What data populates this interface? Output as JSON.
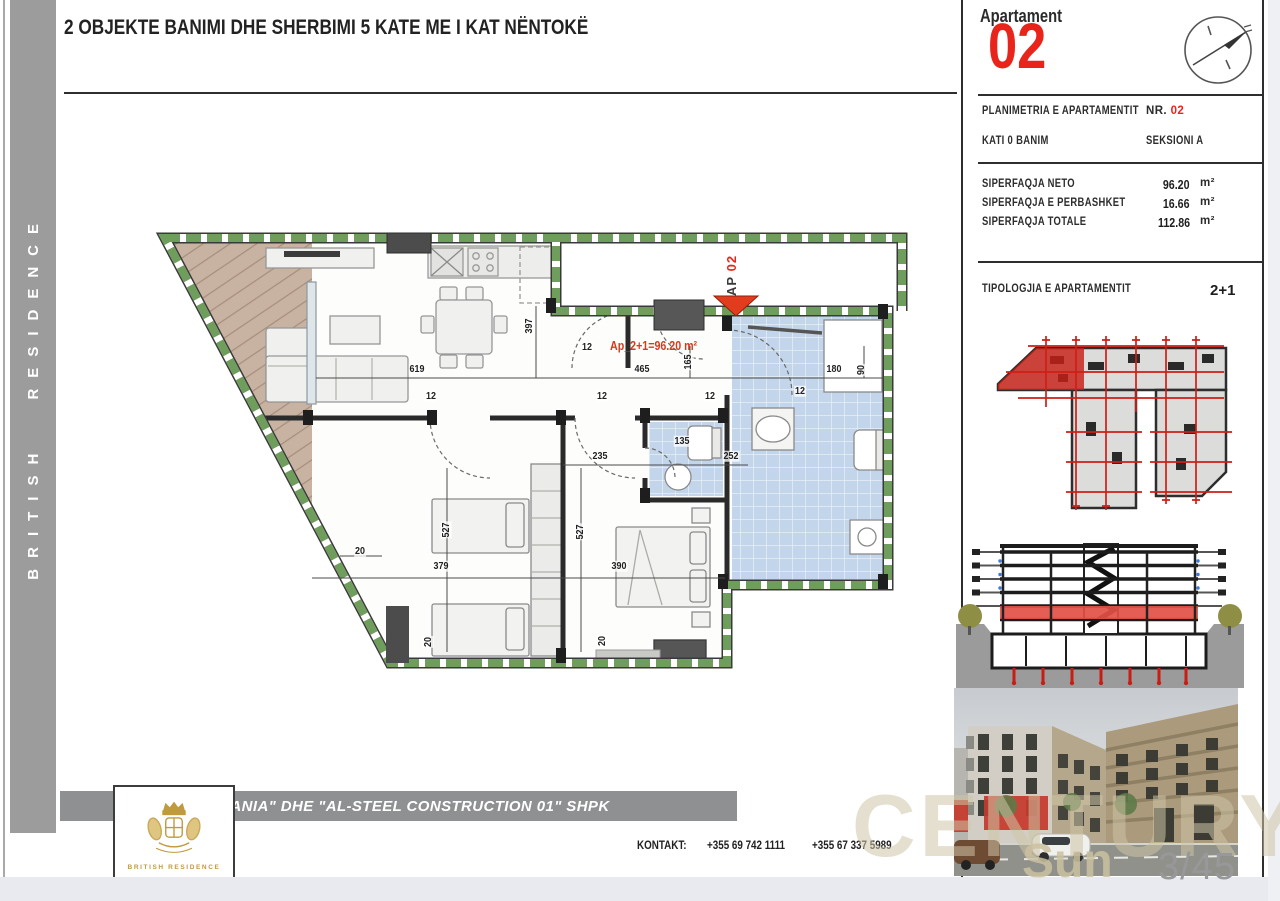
{
  "header": {
    "title": "2 OBJEKTE BANIMI DHE SHERBIMI 5 KATE ME I KAT NËNTOKË"
  },
  "sidebar": {
    "brand": "BRITISH RESIDENCE"
  },
  "logo": {
    "name": "BRITISH RESIDENCE"
  },
  "apartment_panel": {
    "label": "Apartament",
    "number": "02",
    "plan_row": {
      "label": "PLANIMETRIA E APARTAMENTIT",
      "nr_label": "NR.",
      "nr_value": "02"
    },
    "floor_row": {
      "label": "KATI 0 BANIM",
      "section": "SEKSIONI A"
    },
    "areas": [
      {
        "label": "SIPERFAQJA NETO",
        "value": "96.20",
        "unit": "m²"
      },
      {
        "label": "SIPERFAQJA E PERBASHKET",
        "value": "16.66",
        "unit": "m²"
      },
      {
        "label": "SIPERFAQJA TOTALE",
        "value": "112.86",
        "unit": "m²"
      }
    ],
    "typology": {
      "label": "TIPOLOGJIA E APARTAMENTIT",
      "value": "2+1"
    }
  },
  "floor_plan": {
    "entrance_marker_prefix": "AP",
    "entrance_marker_number": "02",
    "area_text": "Ap_2+1=96.20 m²",
    "dimensions": [
      {
        "t": "619",
        "x": 417,
        "y": 369
      },
      {
        "t": "465",
        "x": 642,
        "y": 369
      },
      {
        "t": "180",
        "x": 834,
        "y": 369
      },
      {
        "t": "397",
        "x": 529,
        "y": 326,
        "r": -90
      },
      {
        "t": "165",
        "x": 688,
        "y": 362,
        "r": -90
      },
      {
        "t": "90",
        "x": 861,
        "y": 370,
        "r": -90
      },
      {
        "t": "12",
        "x": 431,
        "y": 396
      },
      {
        "t": "12",
        "x": 602,
        "y": 396
      },
      {
        "t": "12",
        "x": 710,
        "y": 396
      },
      {
        "t": "12",
        "x": 800,
        "y": 391
      },
      {
        "t": "12",
        "x": 587,
        "y": 347
      },
      {
        "t": "135",
        "x": 682,
        "y": 441
      },
      {
        "t": "235",
        "x": 600,
        "y": 456
      },
      {
        "t": "252",
        "x": 731,
        "y": 456
      },
      {
        "t": "527",
        "x": 446,
        "y": 530,
        "r": -90
      },
      {
        "t": "527",
        "x": 580,
        "y": 532,
        "r": -90
      },
      {
        "t": "379",
        "x": 441,
        "y": 566
      },
      {
        "t": "390",
        "x": 619,
        "y": 566
      },
      {
        "t": "20",
        "x": 360,
        "y": 551
      },
      {
        "t": "20",
        "x": 428,
        "y": 642,
        "r": -90
      },
      {
        "t": "20",
        "x": 602,
        "y": 641,
        "r": -90
      }
    ]
  },
  "footer": {
    "company": "\"BRITANIA\" DHE \"AL-STEEL CONSTRUCTION 01\" SHPK",
    "contact_label": "KONTAKT:",
    "phones": [
      "+355 69 742 1111",
      "+355 67 337 5989"
    ]
  },
  "page": {
    "number": "3/45",
    "watermark": "CENTURY21",
    "watermark_sub": "Sun"
  },
  "colors": {
    "accent_red": "#e8241b",
    "wall_green": "#6f9d5c",
    "tile_blue": "#c2d5ea",
    "sidebar_gray": "#9c9c9c",
    "watermark_beige": "#cfc5a2"
  }
}
